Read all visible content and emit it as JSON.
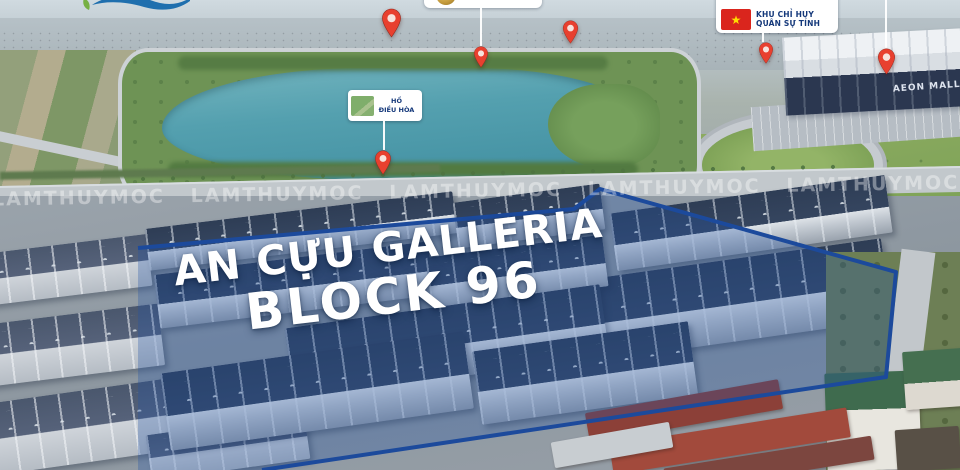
{
  "branding": {
    "logo": {
      "leaf_color": "#76b043",
      "wave_color": "#1f6fae"
    }
  },
  "overlay": {
    "title": {
      "line1": "AN CỰU GALLERIA",
      "line2": "BLOCK 96",
      "color": "#ffffff"
    },
    "watermark": {
      "text": "LAMTHUYMOC",
      "repeats": 7
    },
    "outline_points": "138,248 574,209 600,189 896,272 886,377 262,470",
    "tint_points": "138,248 574,209 600,189 896,272 886,377 262,470 138,470",
    "outline_color": "#1c4a9c",
    "tint_color": "rgba(32,84,164,0.30)"
  },
  "callouts": {
    "lake_label": {
      "line1": "HỒ",
      "line2": "ĐIỀU HÒA"
    },
    "military_label": {
      "line1": "KHU CHỈ HUY",
      "line2": "QUÂN SỰ TỈNH",
      "star": "★"
    },
    "aeon_sign": "AEON MALL"
  },
  "pins": [
    {
      "x": 391,
      "y": 8,
      "h": 30
    },
    {
      "x": 481,
      "y": 46,
      "h": 22
    },
    {
      "x": 570,
      "y": 20,
      "h": 24
    },
    {
      "x": 766,
      "y": 42,
      "h": 22
    },
    {
      "x": 886,
      "y": 48,
      "h": 27
    },
    {
      "x": 383,
      "y": 150,
      "h": 25
    }
  ],
  "leader_lines": [
    {
      "x": 480,
      "y1": 6,
      "y2": 46
    },
    {
      "x": 762,
      "y1": 24,
      "y2": 42
    },
    {
      "x": 885,
      "y1": 0,
      "y2": 48
    },
    {
      "x": 383,
      "y1": 116,
      "y2": 150
    }
  ],
  "colors": {
    "pin_red": "#e8402f",
    "pin_hole": "#f7e3dd",
    "flag_red": "#da251d",
    "star_yellow": "#ffde00",
    "label_text_blue": "#14387a",
    "lake_teal": "#4f9dad",
    "outline_blue": "#1c4a9c"
  }
}
